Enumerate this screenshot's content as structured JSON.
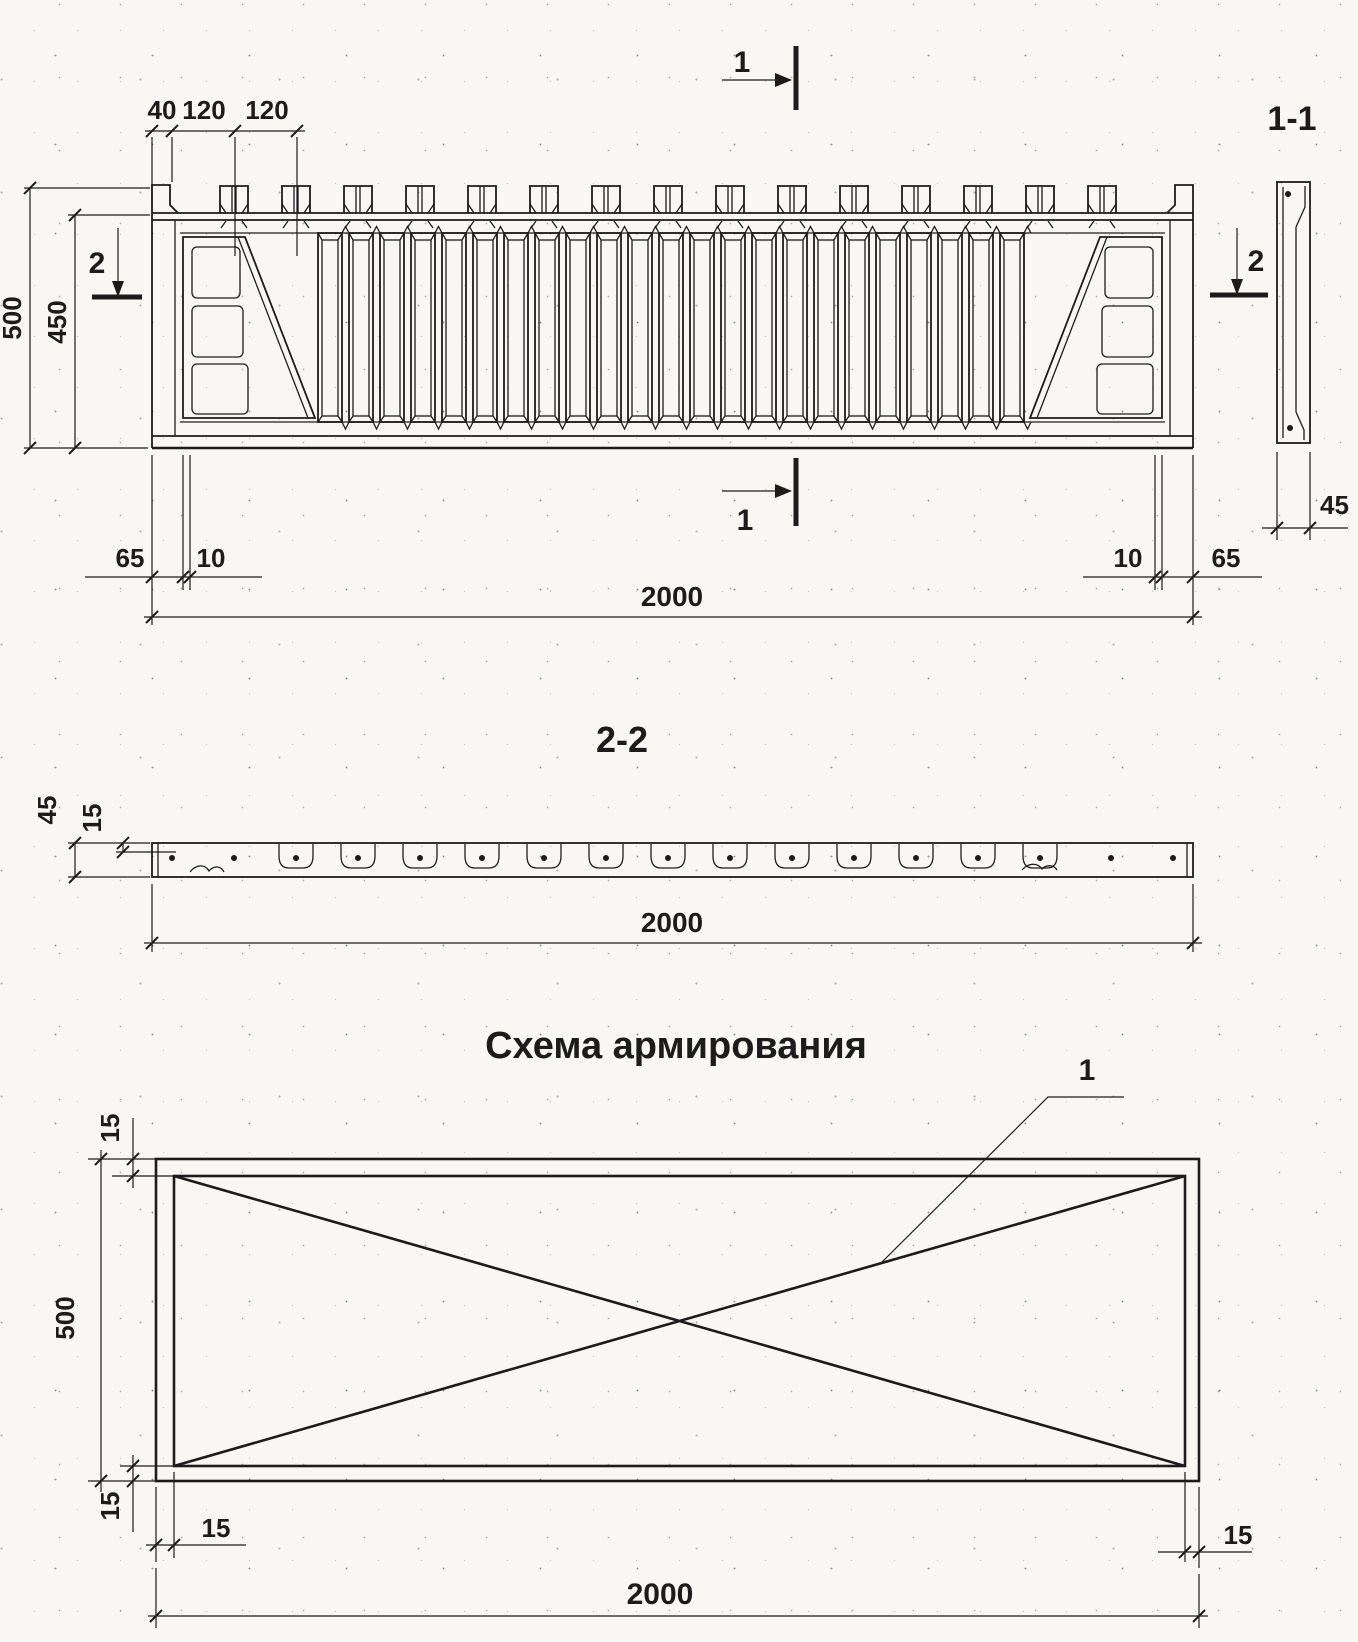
{
  "drawing": {
    "front_view": {
      "section_cut_top_label": "1",
      "section_cut_bottom_label": "1",
      "section_cut_left_label": "2",
      "section_cut_right_label": "2",
      "dim_edge_offset": "40",
      "dim_tooth_pitch_1": "120",
      "dim_tooth_pitch_2": "120",
      "dim_total_height": "500",
      "dim_body_height": "450",
      "dim_left_margin": "65",
      "dim_left_gap": "10",
      "dim_right_gap": "10",
      "dim_right_margin": "65",
      "dim_length": "2000"
    },
    "section_1_1": {
      "title": "1-1",
      "dim_thickness": "45"
    },
    "section_2_2": {
      "title": "2-2",
      "dim_thickness": "45",
      "dim_axis_offset": "15",
      "dim_length": "2000"
    },
    "reinforcement_scheme": {
      "title": "Схема армирования",
      "callout_label": "1",
      "dim_top_cover": "15",
      "dim_height": "500",
      "dim_bottom_cover": "15",
      "dim_left_cover": "15",
      "dim_right_cover": "15",
      "dim_length": "2000"
    },
    "colors": {
      "ink": "#1c1c1c",
      "paper": "#f8f7f4"
    }
  }
}
